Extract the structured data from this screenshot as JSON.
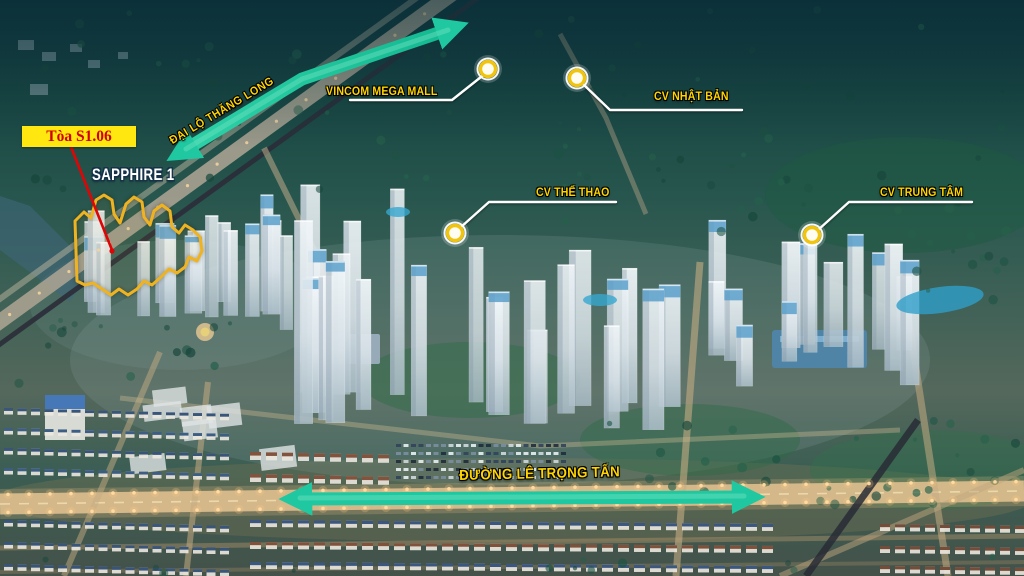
{
  "labels": {
    "building_box": "Tòa S1.06",
    "zone": "SAPPHIRE 1",
    "road_diagonal": "ĐẠI LỘ THĂNG LONG",
    "road_bottom": "ĐƯỜNG LÊ TRỌNG TẤN",
    "poi": [
      {
        "name": "VINCOM MEGA MALL"
      },
      {
        "name": "CV NHẬT BẢN"
      },
      {
        "name": "CV THỂ THAO"
      },
      {
        "name": "CV TRUNG TÂM"
      }
    ]
  },
  "colors": {
    "label_yellow": "#ffd400",
    "zone_text": "#ffffff",
    "arrow_teal": "#1fc8a0",
    "highlight_outline": "#f0b320",
    "callout_box_bg": "#ffe70f",
    "callout_box_text": "#d10000",
    "marker_ring": "#f1c40f",
    "callout_line": "#ffffff"
  }
}
